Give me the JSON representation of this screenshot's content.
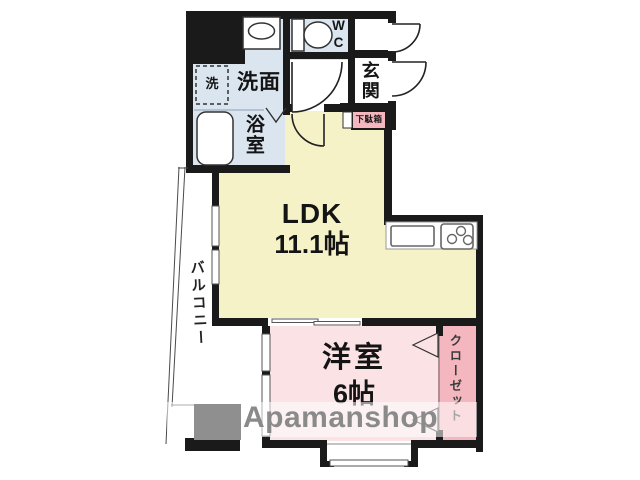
{
  "floorplan": {
    "ldk": {
      "label": "LDK",
      "area": "11.1帖"
    },
    "western_room": {
      "label": "洋室",
      "area": "6帖"
    },
    "closet": {
      "label": "クローゼット"
    },
    "balcony": {
      "label": "バルコニー"
    },
    "entrance": {
      "label": "玄関"
    },
    "shoe_cabinet": {
      "label": "下駄箱"
    },
    "washroom": {
      "label": "洗面"
    },
    "washing_machine": {
      "label": "洗"
    },
    "bathroom": {
      "label": "浴室"
    },
    "toilet": {
      "label": "WC"
    }
  },
  "watermark": {
    "brand": "Apamanshop"
  },
  "colors": {
    "wall": "#1a1a1a",
    "ldk_fill": "#f6f2c8",
    "sanitary_fill": "#dbe5f0",
    "room_fill": "#fbe2e5",
    "accent_pink": "#f4b6bf",
    "watermark_gray": "#8a8a8a"
  }
}
